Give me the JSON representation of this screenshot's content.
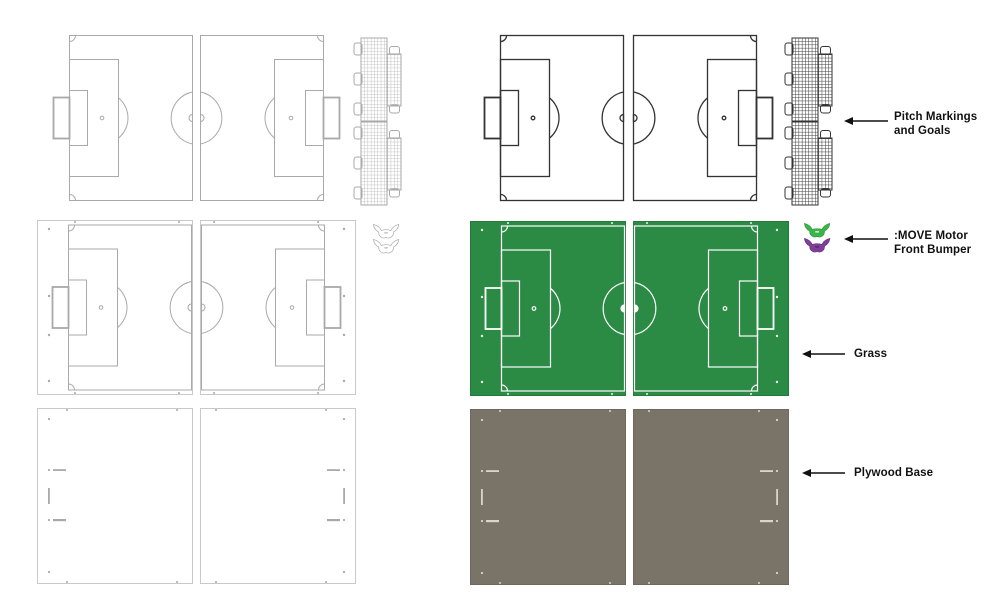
{
  "canvas": {
    "width": 1000,
    "height": 609,
    "background": "#ffffff"
  },
  "colors": {
    "outline_gray": "#a9a9a9",
    "panel_border": "#c9c9c9",
    "dark_line": "#333333",
    "grass_green": "#2b8b45",
    "grass_edge": "#25793a",
    "marking_white": "#ffffff",
    "plywood_taupe": "#7a7468",
    "plywood_edge": "#6f685d",
    "plywood_hole": "#d9d5c9",
    "bumper_green": "#3cb44b",
    "bumper_green_edge": "#2f9e3e",
    "bumper_purple": "#7e3f98",
    "bumper_purple_edge": "#6a3283",
    "label_text": "#111111",
    "arrow": "#111111"
  },
  "annotations": [
    {
      "id": "pitch_markings",
      "lines": [
        "Pitch Markings",
        "and Goals"
      ]
    },
    {
      "id": "move_bumper",
      "lines": [
        ":MOVE Motor",
        "Front Bumper"
      ]
    },
    {
      "id": "grass",
      "lines": [
        "Grass"
      ]
    },
    {
      "id": "plywood",
      "lines": [
        "Plywood Base"
      ]
    }
  ]
}
